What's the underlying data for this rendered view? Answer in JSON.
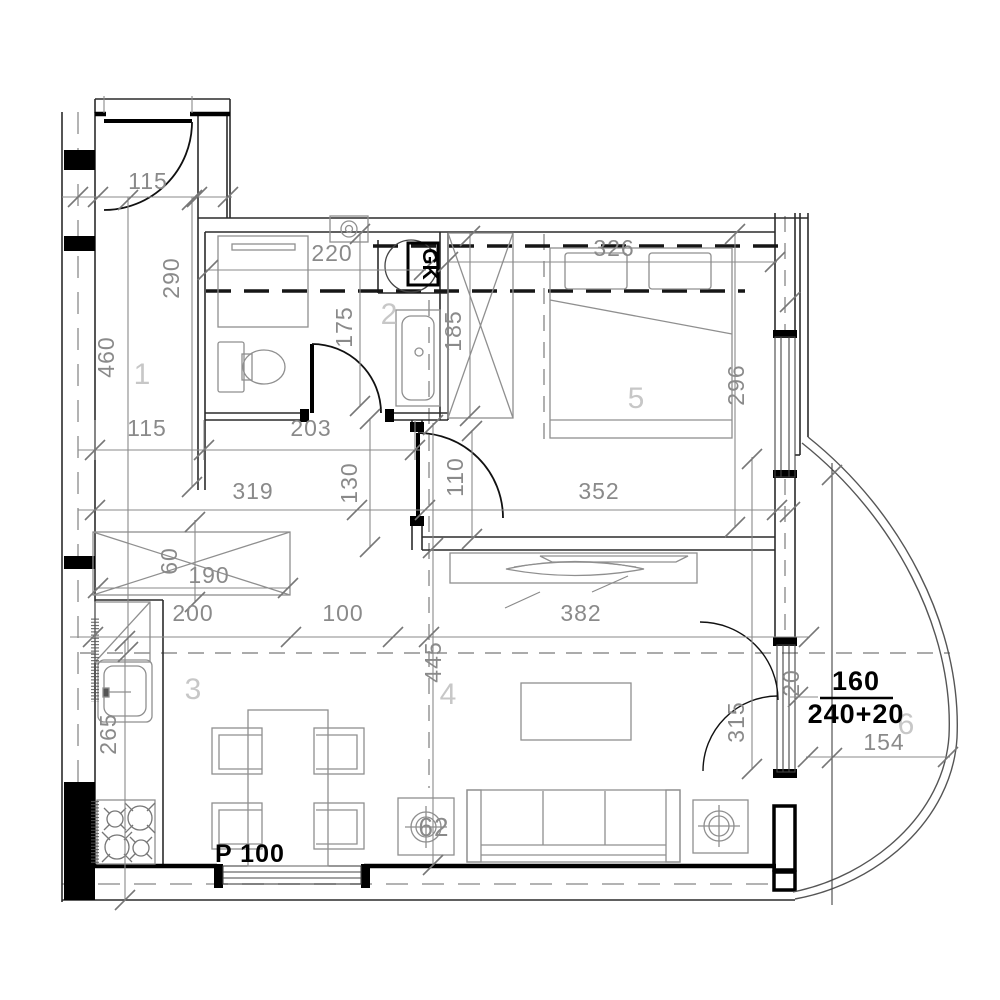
{
  "plan": {
    "type": "apartment-floor-plan",
    "rooms": {
      "r1": "1",
      "r2": "2",
      "r3": "3",
      "r4": "4",
      "r5": "5",
      "r6": "6"
    },
    "dims": {
      "entry_door": "115",
      "hall_segment": "290",
      "hall_length": "460",
      "vanity_width": "220",
      "bath_depth": "175",
      "closet_length": "185",
      "bed_width": "326",
      "bedroom_depth": "296",
      "hall_width": "115",
      "bath_width": "203",
      "hall_lower": "319",
      "hall_gap": "130",
      "bedroom_door": "110",
      "bedroom_width": "352",
      "closet_depth": "60",
      "closet_width": "190",
      "closet_span": "200",
      "passage": "100",
      "tv_wall": "382",
      "living_depth": "445",
      "kitchen_run": "265",
      "balcony_door": "315",
      "wall_offset": "20",
      "balcony_width": "154",
      "side_table": "62"
    },
    "marks": {
      "washer": "GK",
      "window_width": "160",
      "window_height": "240+20",
      "parapet": "P 100"
    },
    "colors": {
      "wall": "#1a1a1a",
      "dimension": "#8a8a8a",
      "room_label": "#c7c7c7",
      "furniture": "#8f8f8f",
      "accent": "#000000",
      "background": "#ffffff"
    }
  }
}
